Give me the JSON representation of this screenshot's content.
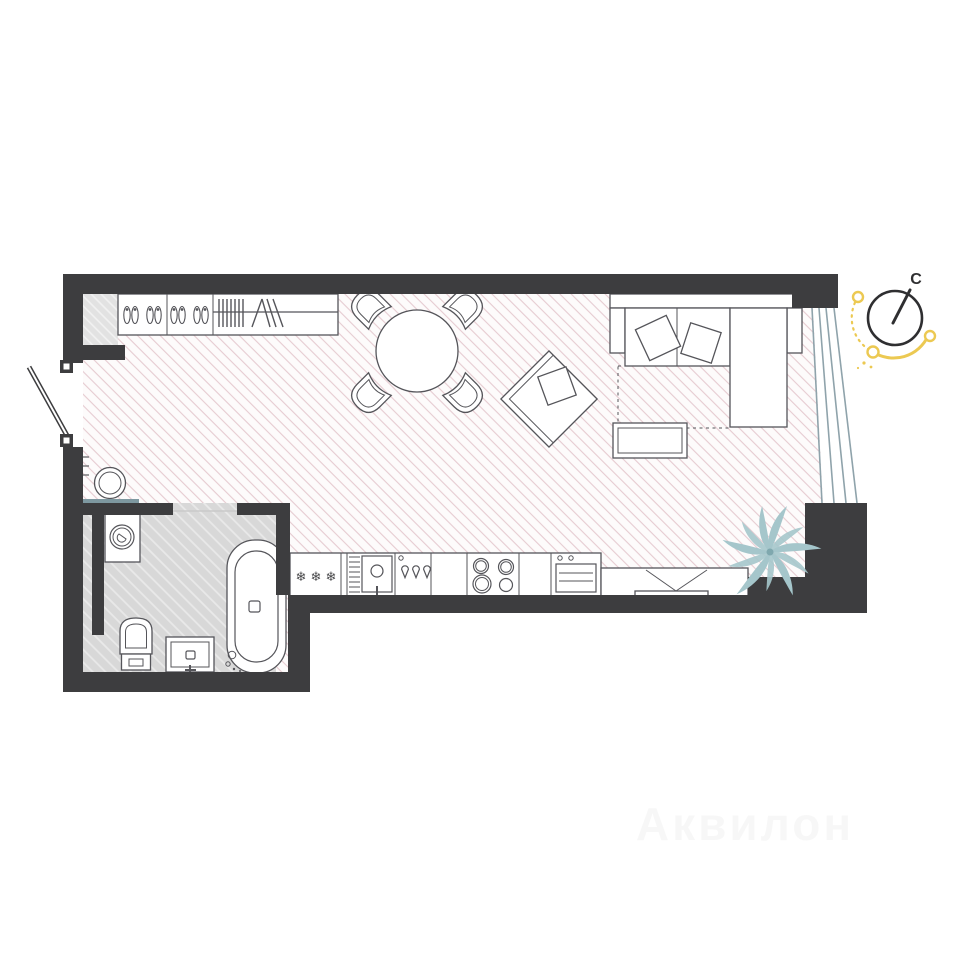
{
  "plan": {
    "type": "studio-apartment-floor-plan",
    "compass": {
      "north_label": "C"
    },
    "kitchen": {
      "snowflake": "❄"
    },
    "watermark": "Аквилон",
    "furniture": [
      "ventilation-shaft",
      "entry-door",
      "wardrobe-shoe-shelves",
      "wardrobe-hanger-rail",
      "stool",
      "console-bench",
      "dining-table",
      "dining-chair-x4",
      "armchair-with-pillow",
      "corner-sofa",
      "sofa-pillows",
      "sofa-pullout-dashed",
      "coffee-table",
      "fridge",
      "dish-rack",
      "kitchen-sink",
      "dishwasher",
      "hob",
      "oven",
      "tv-console",
      "tv",
      "washing-machine",
      "toilet",
      "vanity-sink",
      "bathtub",
      "plant",
      "panoramic-window",
      "compass",
      "sun-path"
    ]
  },
  "colors": {
    "wall": "#3d3d3f",
    "line": "#55555a",
    "floor-bg": "#fdfbfb",
    "hatch-pink": "#e6cbd1",
    "bath-bg": "#d8d8d8",
    "hatch-bath": "#e9e9e9",
    "shaft-bg": "#e2e2e2",
    "hatch-shaft": "#f2f2f2",
    "window": "#8fa3ab",
    "teal": "#7e98a0",
    "plant": "#a5c6cb",
    "plant-center": "#7fa8ae",
    "sun": "#ecc952",
    "compass": "#2f2f31"
  }
}
